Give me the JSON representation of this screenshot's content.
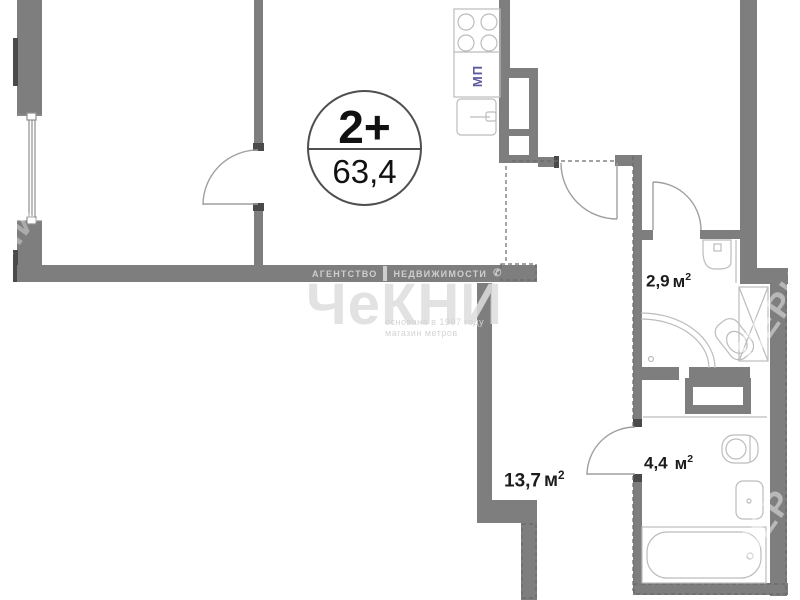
{
  "badge": {
    "room_type": "2+",
    "total_area": "63,4"
  },
  "rooms": {
    "bathroom_small": {
      "area": "2,9",
      "unit": "м",
      "unit_sup": "2"
    },
    "bathroom_large": {
      "area": "4,4",
      "unit": "м",
      "unit_sup": "2"
    },
    "hallway": {
      "area": "13,7",
      "unit": "м",
      "unit_sup": "2"
    }
  },
  "kitchen": {
    "appliance_label": "МП"
  },
  "watermark": {
    "agency_word1": "АГЕНТСТВО",
    "agency_word2": "НЕДВИЖИМОСТИ",
    "phone_glyph": "✆",
    "brand": "ЧеКНИ",
    "tagline1": "основана в 1997 году",
    "tagline2": "магазин метров",
    "edge1": "ПЕРИ",
    "edge2": "ПЕР",
    "edge3": "НИ"
  },
  "icons": {
    "stove": "stove-burners-icon",
    "kitchen_sink": "kitchen-sink-icon",
    "corner_sink": "corner-sink-icon",
    "shower": "corner-shower-icon",
    "toilet": "toilet-icon",
    "washbasin": "washbasin-icon",
    "bathtub": "bathtub-icon",
    "duct": "vent-duct-icon"
  },
  "colors": {
    "wall": "#7e7e7e",
    "wall_dark": "#4a4a4a",
    "fixture_line": "#bcbcbc",
    "door_line": "#9f9f9f",
    "label_text": "#1c1c1c",
    "appliance_text": "#5b5ba0",
    "watermark": "#dedede"
  }
}
